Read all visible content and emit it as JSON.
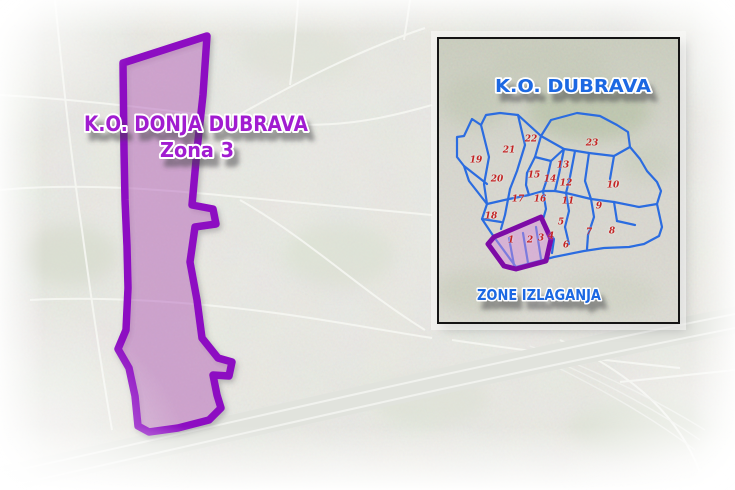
{
  "main_map": {
    "title": "K.O. DONJA DUBRAVA",
    "subtitle": "Zona 3",
    "title_color": "#a11fd0",
    "zone_outline_color": "#8d11c2",
    "zone_fill_color": "rgba(190,95,195,0.40)"
  },
  "inset_map": {
    "title": "K.O. DUBRAVA",
    "footer_label": "ZONE IZLAGANJA",
    "label_color": "#1b67e2",
    "network_color": "#2b6ce0",
    "highlight_outline_color": "#7d0ba6",
    "highlight_fill_color": "rgba(214,140,218,0.48)",
    "number_color": "#c42424",
    "zones": [
      {
        "label": "1",
        "x": 72,
        "y": 202
      },
      {
        "label": "2",
        "x": 91,
        "y": 202
      },
      {
        "label": "3",
        "x": 102,
        "y": 200
      },
      {
        "label": "4",
        "x": 112,
        "y": 198
      },
      {
        "label": "5",
        "x": 122,
        "y": 184
      },
      {
        "label": "6",
        "x": 127,
        "y": 207
      },
      {
        "label": "7",
        "x": 150,
        "y": 194
      },
      {
        "label": "8",
        "x": 173,
        "y": 193
      },
      {
        "label": "9",
        "x": 160,
        "y": 168
      },
      {
        "label": "10",
        "x": 174,
        "y": 147
      },
      {
        "label": "11",
        "x": 129,
        "y": 163
      },
      {
        "label": "12",
        "x": 127,
        "y": 145
      },
      {
        "label": "13",
        "x": 124,
        "y": 127
      },
      {
        "label": "14",
        "x": 111,
        "y": 141
      },
      {
        "label": "15",
        "x": 95,
        "y": 137
      },
      {
        "label": "16",
        "x": 101,
        "y": 161
      },
      {
        "label": "17",
        "x": 79,
        "y": 161
      },
      {
        "label": "18",
        "x": 52,
        "y": 178
      },
      {
        "label": "19",
        "x": 37,
        "y": 122
      },
      {
        "label": "20",
        "x": 58,
        "y": 141
      },
      {
        "label": "21",
        "x": 70,
        "y": 112
      },
      {
        "label": "22",
        "x": 92,
        "y": 101
      },
      {
        "label": "23",
        "x": 153,
        "y": 105
      }
    ]
  }
}
